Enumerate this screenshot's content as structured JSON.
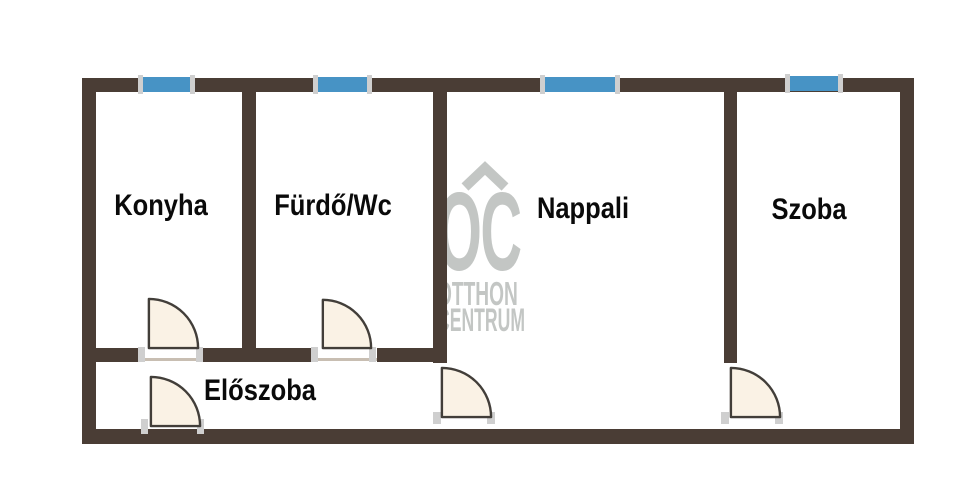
{
  "rooms": [
    {
      "id": "konyha",
      "label": "Konyha"
    },
    {
      "id": "furdo",
      "label": "Fürdő/Wc"
    },
    {
      "id": "nappali",
      "label": "Nappali"
    },
    {
      "id": "szoba",
      "label": "Szoba"
    },
    {
      "id": "eloszoba",
      "label": "Előszoba"
    }
  ],
  "watermark": {
    "logo": "OC",
    "line1": "OTTHON",
    "line2": "CENTRUM"
  },
  "fixtures": {
    "windows": [
      "window-konyha",
      "window-furdo",
      "window-nappali",
      "window-szoba"
    ],
    "doors": [
      "door-konyha",
      "door-furdo",
      "door-entry",
      "door-nappali",
      "door-szoba"
    ]
  },
  "colors": {
    "wall": "#4a3d35",
    "window": "#4793c5",
    "door_fill": "#faf2e5",
    "door_stroke": "#423e39",
    "jamb": "#cfcfcf",
    "threshold": "#c8beb2",
    "watermark": "#c3c6c4",
    "text": "#0a0a0a",
    "background": "#ffffff"
  }
}
